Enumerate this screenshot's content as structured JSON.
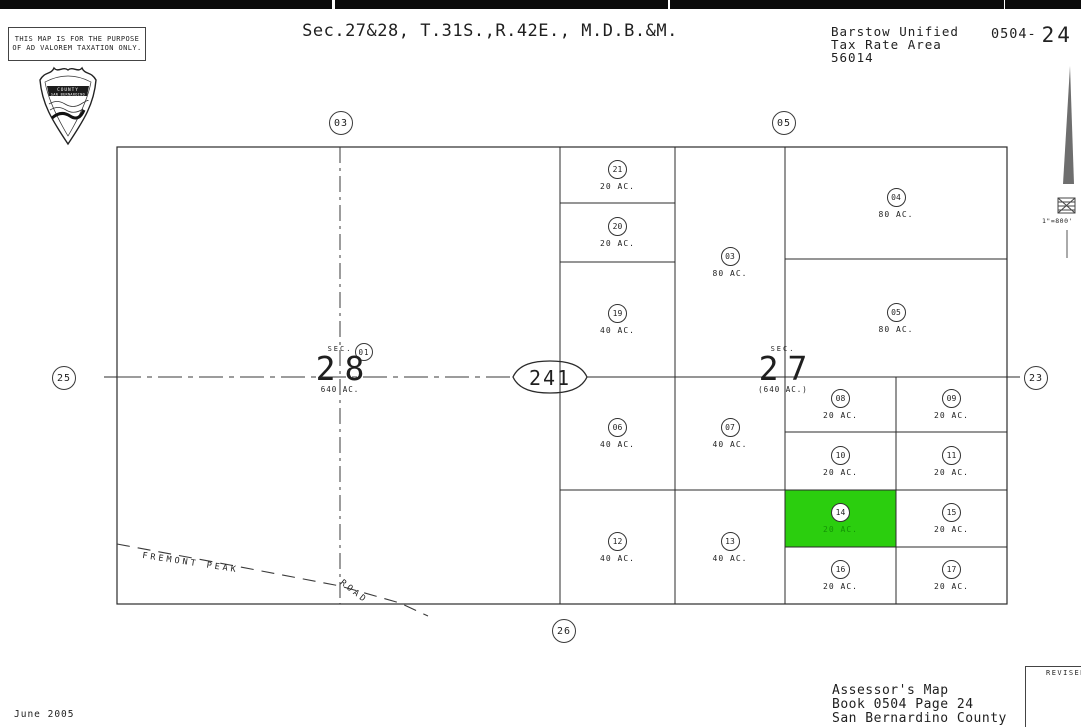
{
  "colors": {
    "highlight_green": "#2BCE0E",
    "ink": "#1F1F1F",
    "paper": "#FFFFFF"
  },
  "header": {
    "disclaimer_line1": "THIS MAP IS FOR THE PURPOSE",
    "disclaimer_line2": "OF AD VALOREM TAXATION ONLY.",
    "title": "Sec.27&28, T.31S.,R.42E., M.D.B.&M.",
    "tax_area_line1": "Barstow Unified",
    "tax_area_line2": "Tax Rate Area",
    "tax_area_line3": "56014",
    "book_code": "0504-",
    "page_number": "24"
  },
  "seal": {
    "line1": "COUNTY",
    "line2": "SAN BERNARDINO"
  },
  "compass": {
    "scale_label": "1\"=800'"
  },
  "map": {
    "route_marker": "241",
    "refs": {
      "top_left": "03",
      "top_right": "05",
      "left": "25",
      "right": "23",
      "bottom": "26",
      "inner": "01"
    },
    "sections": [
      {
        "prefix": "SEC.",
        "number": "28",
        "acreage": "640 AC."
      },
      {
        "prefix": "SEC.",
        "number": "27",
        "acreage": "(640 AC.)"
      }
    ],
    "road": {
      "name": "FREMONT PEAK",
      "suffix": "ROAD"
    },
    "parcels": [
      {
        "id": "21",
        "acreage": "20 AC.",
        "highlighted": false
      },
      {
        "id": "20",
        "acreage": "20 AC.",
        "highlighted": false
      },
      {
        "id": "19",
        "acreage": "40 AC.",
        "highlighted": false
      },
      {
        "id": "03",
        "acreage": "80 AC.",
        "highlighted": false
      },
      {
        "id": "04",
        "acreage": "80 AC.",
        "highlighted": false
      },
      {
        "id": "05",
        "acreage": "80 AC.",
        "highlighted": false
      },
      {
        "id": "06",
        "acreage": "40 AC.",
        "highlighted": false
      },
      {
        "id": "07",
        "acreage": "40 AC.",
        "highlighted": false
      },
      {
        "id": "08",
        "acreage": "20 AC.",
        "highlighted": false
      },
      {
        "id": "09",
        "acreage": "20 AC.",
        "highlighted": false
      },
      {
        "id": "10",
        "acreage": "20 AC.",
        "highlighted": false
      },
      {
        "id": "11",
        "acreage": "20 AC.",
        "highlighted": false
      },
      {
        "id": "12",
        "acreage": "40 AC.",
        "highlighted": false
      },
      {
        "id": "13",
        "acreage": "40 AC.",
        "highlighted": false
      },
      {
        "id": "14",
        "acreage": "20 AC.",
        "highlighted": true
      },
      {
        "id": "15",
        "acreage": "20 AC.",
        "highlighted": false
      },
      {
        "id": "16",
        "acreage": "20 AC.",
        "highlighted": false
      },
      {
        "id": "17",
        "acreage": "20 AC.",
        "highlighted": false
      }
    ]
  },
  "footer": {
    "date": "June 2005",
    "assessor_line1": "Assessor's Map",
    "assessor_line2": "Book 0504 Page 24",
    "assessor_line3": "San Bernardino County",
    "revised_label": "REVISED"
  }
}
